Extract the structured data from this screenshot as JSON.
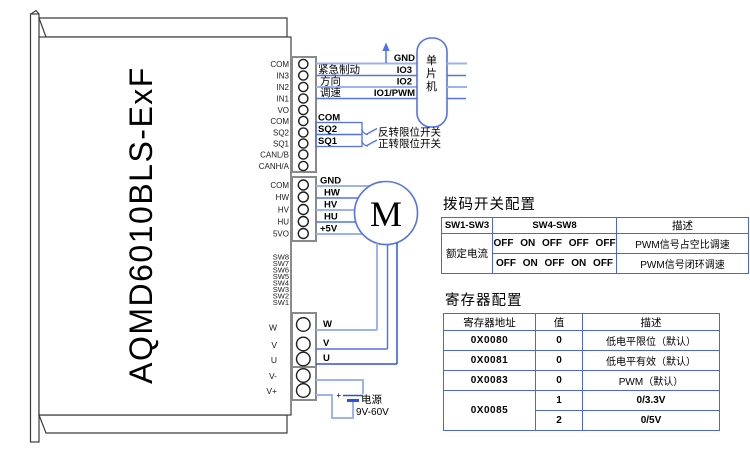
{
  "colors": {
    "wire_light": "#9db2f4",
    "wire_mid": "#5272ea",
    "wire_dark": "#2e52e0",
    "table_border": "#4a66d9",
    "outline_gray": "#8a8a8a",
    "text": "#000000"
  },
  "device": {
    "model": "AQMD6010BLS-ExF",
    "conn1": [
      "COM",
      "IN3",
      "IN2",
      "IN1",
      "VO",
      "COM",
      "SQ2",
      "SQ1",
      "CANL/B",
      "CANH/A"
    ],
    "conn2": [
      "COM",
      "HW",
      "HV",
      "HU",
      "5VO"
    ],
    "sw_pins": [
      "SW8",
      "SW7",
      "SW6",
      "SW5",
      "SW4",
      "SW3",
      "SW2",
      "SW1"
    ],
    "conn3": [
      "W",
      "V",
      "U"
    ],
    "conn4": [
      "V-",
      "V+"
    ]
  },
  "mcu": {
    "label": "单片机",
    "pins": {
      "gnd": "GND",
      "io3": "IO3",
      "io2": "IO2",
      "io1": "IO1/PWM"
    }
  },
  "signals": {
    "brake": "紧急制动",
    "dir": "方向",
    "speed": "调速",
    "com": "COM",
    "sq2": "SQ2",
    "sq1": "SQ1",
    "rev_limit": "反转限位开关",
    "fwd_limit": "正转限位开关"
  },
  "motor": {
    "label": "M",
    "gnd": "GND",
    "hw": "HW",
    "hv": "HV",
    "hu": "HU",
    "p5v": "+5V",
    "w": "W",
    "v": "V",
    "u": "U"
  },
  "power": {
    "plus": "+",
    "label": "电源",
    "range": "9V-60V"
  },
  "dip_table": {
    "title": "拨码开关配置",
    "headers": [
      "SW1-SW3",
      "SW4-SW8",
      "描述"
    ],
    "row_label": "额定电流",
    "rows": [
      {
        "sw": "OFF ON OFF OFF OFF",
        "desc": "PWM信号占空比调速"
      },
      {
        "sw": "OFF ON OFF ON OFF",
        "desc": "PWM信号闭环调速"
      }
    ]
  },
  "reg_table": {
    "title": "寄存器配置",
    "headers": [
      "寄存器地址",
      "值",
      "描述"
    ],
    "rows": [
      {
        "addr": "0X0080",
        "val": "0",
        "desc": "低电平限位（默认）"
      },
      {
        "addr": "0X0081",
        "val": "0",
        "desc": "低电平有效（默认）"
      },
      {
        "addr": "0X0083",
        "val": "0",
        "desc": "PWM（默认）"
      },
      {
        "addr": "0X0085",
        "val": "1",
        "desc": "0/3.3V"
      },
      {
        "val": "2",
        "desc": "0/5V"
      }
    ]
  }
}
